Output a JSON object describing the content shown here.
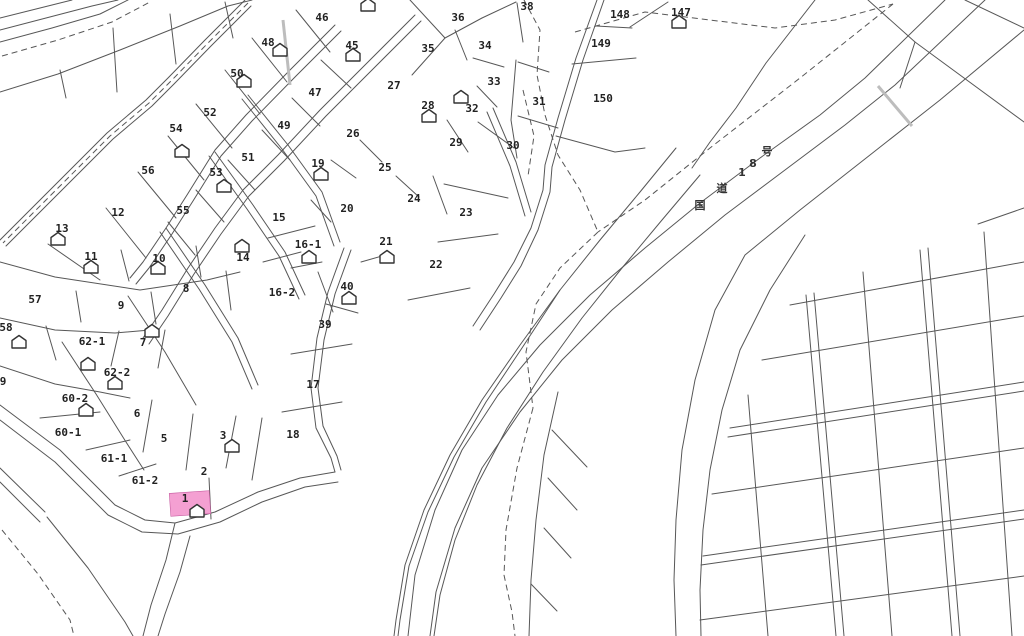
{
  "map": {
    "title": "cadastral-parcel-map",
    "background": "#ffffff",
    "line_color": "#575757",
    "label_color": "#222222",
    "highlight": {
      "label": "1",
      "color": "#f4a0d2",
      "x": 170,
      "y": 492,
      "width": 40,
      "height": 23,
      "tilt": -4,
      "house": {
        "x": 197,
        "y": 511
      }
    },
    "road_label": {
      "text": "国道18号",
      "chars": [
        {
          "ch": "国",
          "x": 700,
          "y": 205
        },
        {
          "ch": "道",
          "x": 722,
          "y": 188
        },
        {
          "ch": "1",
          "x": 742,
          "y": 172
        },
        {
          "ch": "8",
          "x": 753,
          "y": 163
        },
        {
          "ch": "号",
          "x": 767,
          "y": 151
        }
      ]
    },
    "parcels": [
      {
        "label": "46",
        "x": 322,
        "y": 17
      },
      {
        "label": "48",
        "x": 268,
        "y": 42
      },
      {
        "label": "45",
        "x": 352,
        "y": 45
      },
      {
        "label": "36",
        "x": 458,
        "y": 17
      },
      {
        "label": "38",
        "x": 527,
        "y": 6
      },
      {
        "label": "50",
        "x": 237,
        "y": 73
      },
      {
        "label": "35",
        "x": 428,
        "y": 48
      },
      {
        "label": "34",
        "x": 485,
        "y": 45
      },
      {
        "label": "147",
        "x": 681,
        "y": 12
      },
      {
        "label": "148",
        "x": 620,
        "y": 14
      },
      {
        "label": "149",
        "x": 601,
        "y": 43
      },
      {
        "label": "27",
        "x": 394,
        "y": 85
      },
      {
        "label": "28",
        "x": 428,
        "y": 105
      },
      {
        "label": "32",
        "x": 472,
        "y": 108
      },
      {
        "label": "33",
        "x": 494,
        "y": 81
      },
      {
        "label": "31",
        "x": 539,
        "y": 101
      },
      {
        "label": "150",
        "x": 603,
        "y": 98
      },
      {
        "label": "52",
        "x": 210,
        "y": 112
      },
      {
        "label": "47",
        "x": 315,
        "y": 92
      },
      {
        "label": "49",
        "x": 284,
        "y": 125
      },
      {
        "label": "54",
        "x": 176,
        "y": 128
      },
      {
        "label": "26",
        "x": 353,
        "y": 133
      },
      {
        "label": "29",
        "x": 456,
        "y": 142
      },
      {
        "label": "30",
        "x": 513,
        "y": 145
      },
      {
        "label": "19",
        "x": 318,
        "y": 163
      },
      {
        "label": "25",
        "x": 385,
        "y": 167
      },
      {
        "label": "51",
        "x": 248,
        "y": 157
      },
      {
        "label": "53",
        "x": 216,
        "y": 172
      },
      {
        "label": "56",
        "x": 148,
        "y": 170
      },
      {
        "label": "24",
        "x": 414,
        "y": 198
      },
      {
        "label": "55",
        "x": 183,
        "y": 210
      },
      {
        "label": "23",
        "x": 466,
        "y": 212
      },
      {
        "label": "12",
        "x": 118,
        "y": 212
      },
      {
        "label": "15",
        "x": 279,
        "y": 217
      },
      {
        "label": "20",
        "x": 347,
        "y": 208
      },
      {
        "label": "13",
        "x": 62,
        "y": 228
      },
      {
        "label": "16-1",
        "x": 308,
        "y": 244
      },
      {
        "label": "21",
        "x": 386,
        "y": 241
      },
      {
        "label": "11",
        "x": 91,
        "y": 256
      },
      {
        "label": "14",
        "x": 243,
        "y": 257
      },
      {
        "label": "10",
        "x": 159,
        "y": 258
      },
      {
        "label": "22",
        "x": 436,
        "y": 264
      },
      {
        "label": "8",
        "x": 186,
        "y": 288
      },
      {
        "label": "16-2",
        "x": 282,
        "y": 292
      },
      {
        "label": "9",
        "x": 121,
        "y": 305
      },
      {
        "label": "40",
        "x": 347,
        "y": 286
      },
      {
        "label": "57",
        "x": 35,
        "y": 299
      },
      {
        "label": "39",
        "x": 325,
        "y": 324
      },
      {
        "label": "58",
        "x": 6,
        "y": 327
      },
      {
        "label": "62-1",
        "x": 92,
        "y": 341
      },
      {
        "label": "7",
        "x": 143,
        "y": 342
      },
      {
        "label": "62-2",
        "x": 117,
        "y": 372
      },
      {
        "label": "9",
        "x": 3,
        "y": 381
      },
      {
        "label": "60-2",
        "x": 75,
        "y": 398
      },
      {
        "label": "17",
        "x": 313,
        "y": 384
      },
      {
        "label": "60-1",
        "x": 68,
        "y": 432
      },
      {
        "label": "6",
        "x": 137,
        "y": 413
      },
      {
        "label": "5",
        "x": 164,
        "y": 438
      },
      {
        "label": "3",
        "x": 223,
        "y": 435
      },
      {
        "label": "61-1",
        "x": 114,
        "y": 458
      },
      {
        "label": "18",
        "x": 293,
        "y": 434
      },
      {
        "label": "2",
        "x": 204,
        "y": 471
      },
      {
        "label": "61-2",
        "x": 145,
        "y": 480
      }
    ],
    "houses": [
      {
        "x": 368,
        "y": 5
      },
      {
        "x": 280,
        "y": 50
      },
      {
        "x": 353,
        "y": 55
      },
      {
        "x": 244,
        "y": 81
      },
      {
        "x": 679,
        "y": 22
      },
      {
        "x": 429,
        "y": 116
      },
      {
        "x": 461,
        "y": 97
      },
      {
        "x": 182,
        "y": 151
      },
      {
        "x": 321,
        "y": 174
      },
      {
        "x": 224,
        "y": 186
      },
      {
        "x": 58,
        "y": 239
      },
      {
        "x": 242,
        "y": 246
      },
      {
        "x": 309,
        "y": 257
      },
      {
        "x": 387,
        "y": 257
      },
      {
        "x": 91,
        "y": 267
      },
      {
        "x": 158,
        "y": 268
      },
      {
        "x": 349,
        "y": 298
      },
      {
        "x": 152,
        "y": 331
      },
      {
        "x": 19,
        "y": 342
      },
      {
        "x": 88,
        "y": 364
      },
      {
        "x": 115,
        "y": 383
      },
      {
        "x": 86,
        "y": 410
      },
      {
        "x": 232,
        "y": 446
      }
    ]
  }
}
